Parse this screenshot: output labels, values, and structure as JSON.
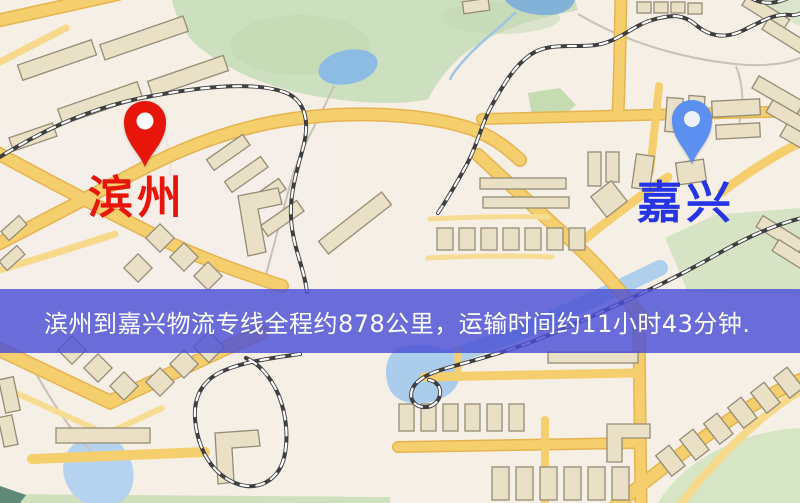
{
  "map": {
    "markers": {
      "origin": {
        "label": "滨州",
        "pin_color": "#e8150a",
        "pin_hole_color": "#ffffff",
        "label_color": "#e8150a",
        "pin_style": "red-teardrop"
      },
      "destination": {
        "label": "嘉兴",
        "pin_color": "#5b8ff0",
        "pin_hole_color": "#eef2f8",
        "label_color": "#2434e6",
        "pin_style": "blue-teardrop"
      }
    },
    "banner": {
      "text": "滨州到嘉兴物流专线全程约878公里，运输时间约11小时43分钟.",
      "distance": "878公里",
      "duration": "11小时43分钟",
      "background_color": "#4a4fd6",
      "text_color": "#ffffff"
    },
    "legend_colors": {
      "background": "#f5efe6",
      "road": "#f5cf6d",
      "road_casing": "#e5b44f",
      "water": "#a9cdec",
      "park": "#ccdfbe",
      "building": "#e9e0c5",
      "building_outline": "#958c77",
      "railway": "#3f3f3f"
    }
  }
}
